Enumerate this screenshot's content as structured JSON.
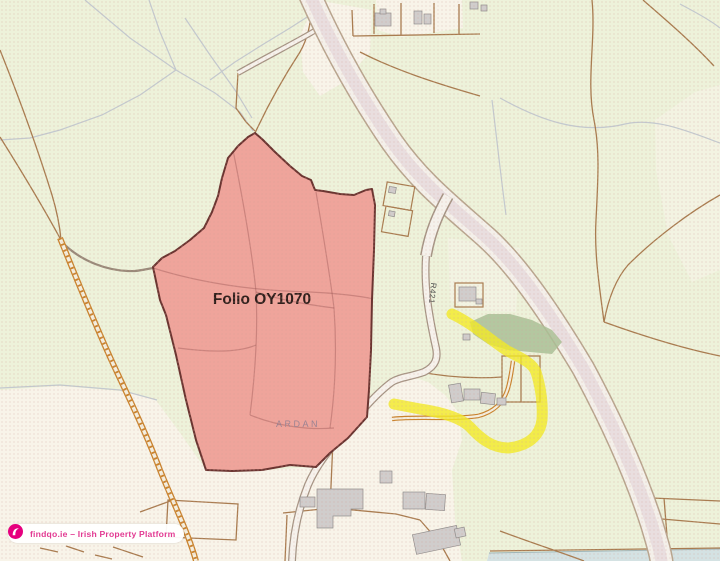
{
  "map": {
    "parcel": {
      "folio_label": "Folio OY1070",
      "fill_color": "#efa49b",
      "border_color": "#6b3531"
    },
    "labels": {
      "townland": "ARDAN",
      "road": "R421"
    },
    "route_highlight_color": "#f3ea25",
    "palette": {
      "background_green": "#edf2da",
      "cream": "#f8f4e9",
      "woodland_green": "#a9c095",
      "road_fill": "#f4f0ea",
      "road_casing": "#b8a58e",
      "boundary_brown": "#a97c50",
      "track_orange": "#c9832e",
      "building_gray": "#d0cdcc",
      "stream_blue": "#d4e2e3"
    }
  },
  "watermark": {
    "text": "findqo.ie – Irish Property Platform",
    "brand_color": "#e23a92",
    "icon": "findqo-logo-icon"
  }
}
